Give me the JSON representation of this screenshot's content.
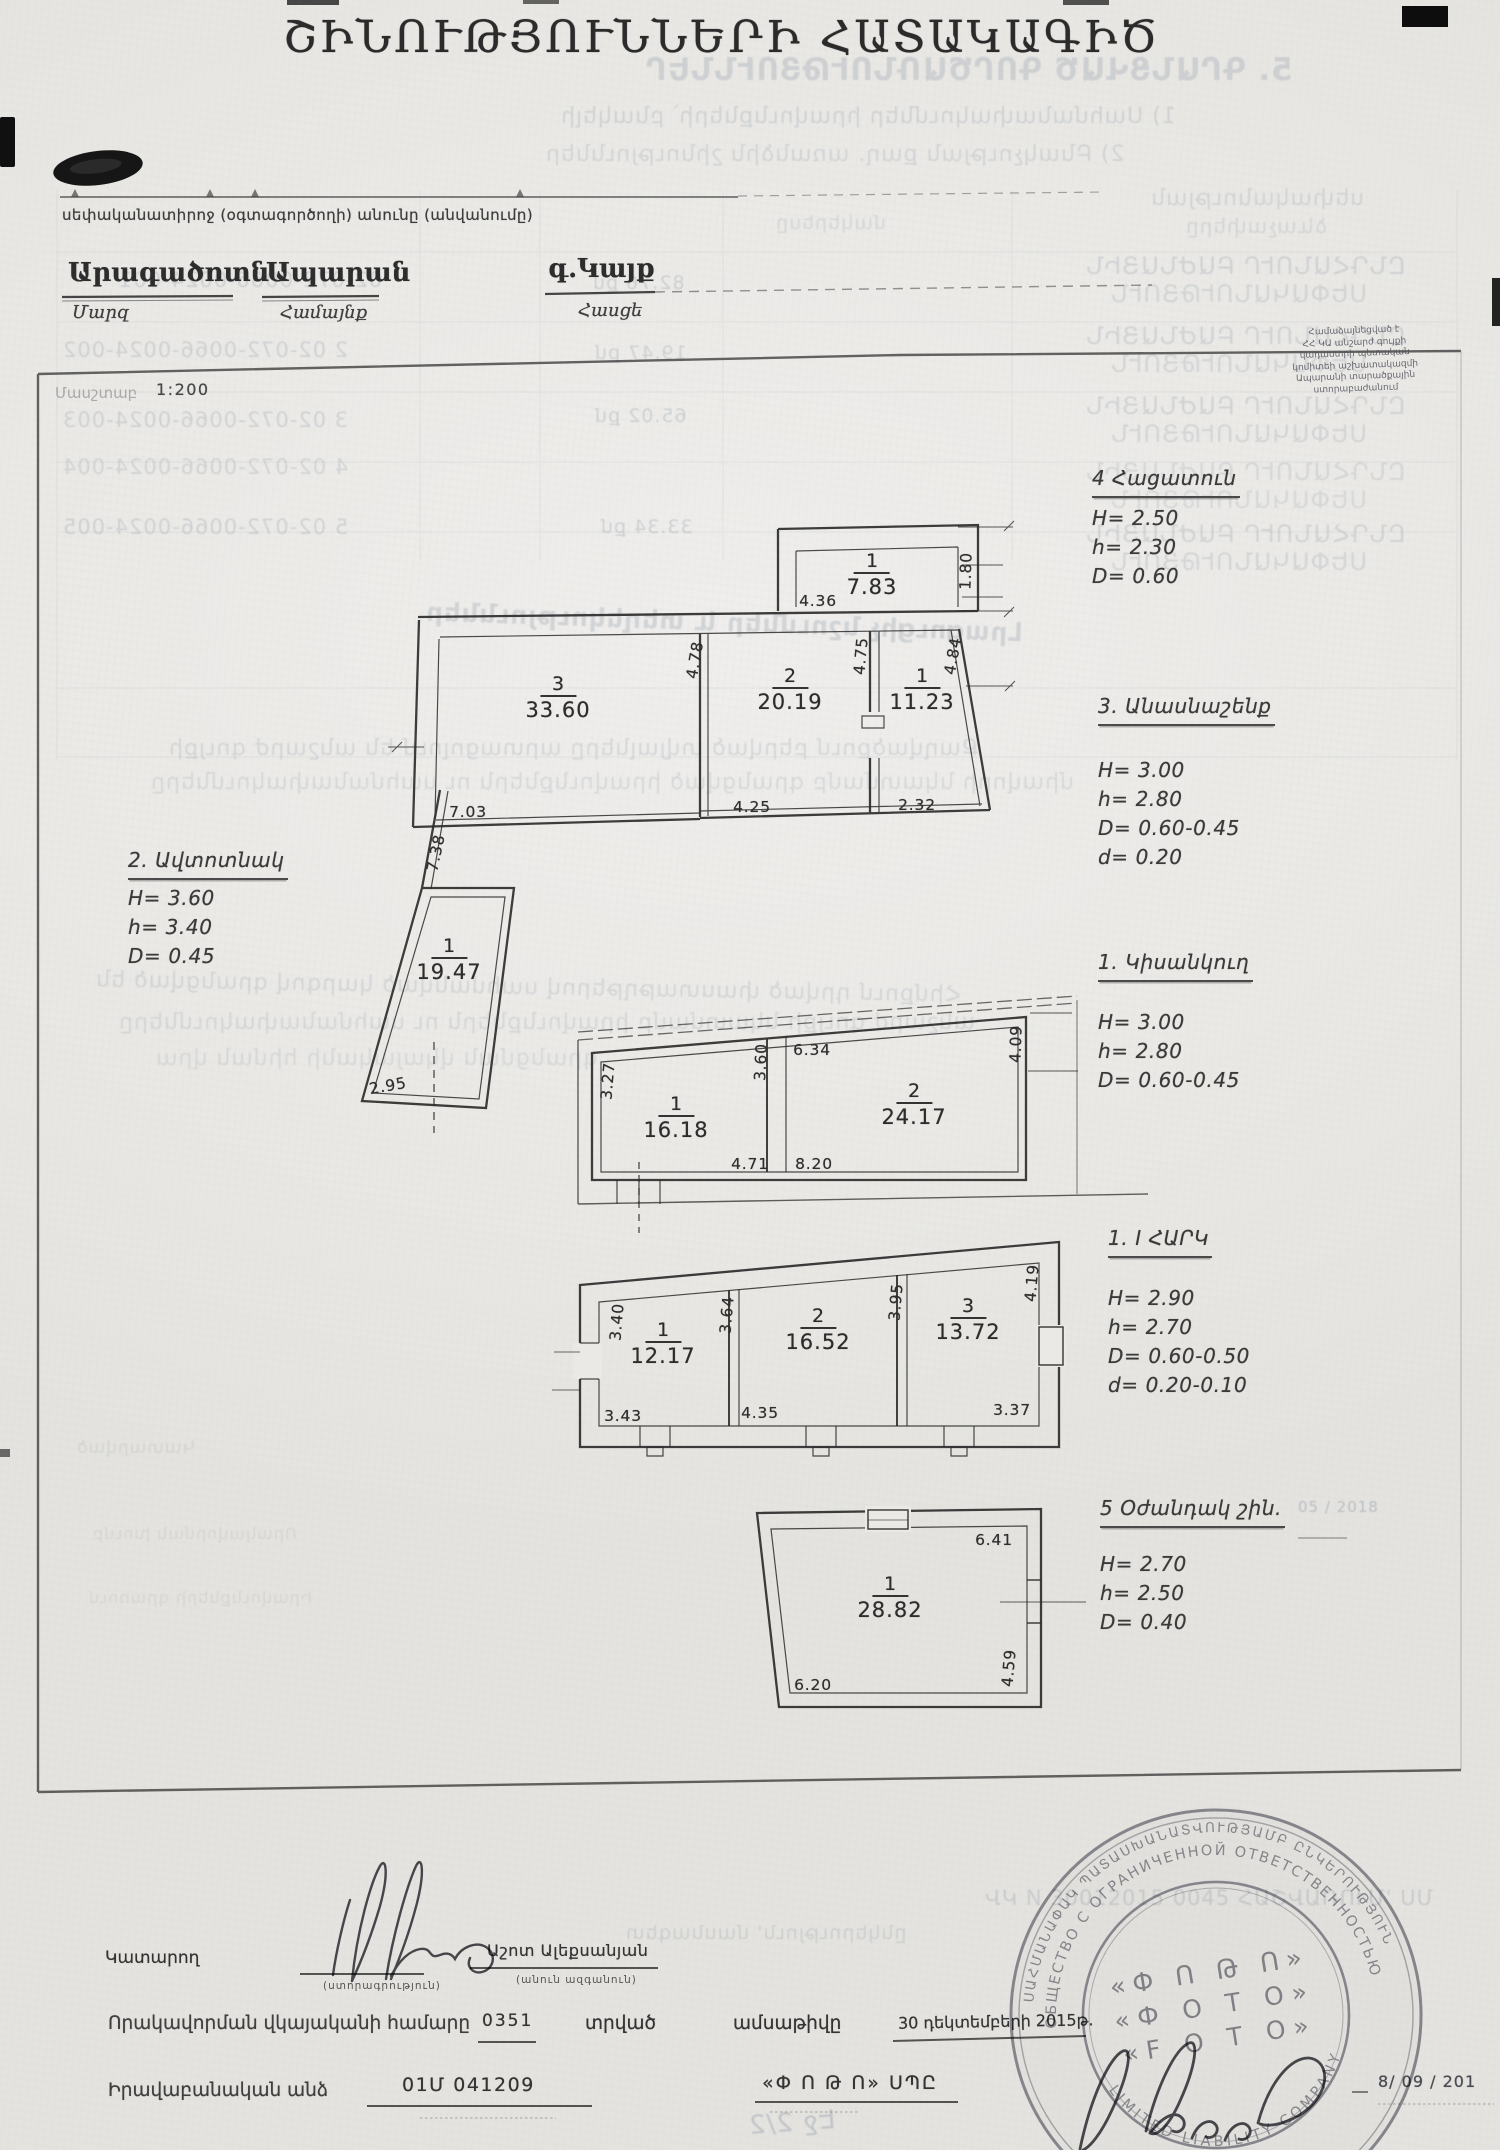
{
  "header": {
    "title": "ՇԻՆՈՒԹՅՈՒՆՆԵՐԻ ՀԱՏԱԿԱԳԻԾ",
    "owner_line": "սեփականատիրոջ (օգտագործողի) անունը (անվանումը)",
    "fields": {
      "marz": {
        "value": "Արագածոտն",
        "label": "Մարզ"
      },
      "community": {
        "value": "Ապարան",
        "label": "Համայնք"
      },
      "address": {
        "value": "գ.Կայք",
        "label": "Հասցե"
      }
    },
    "scale": {
      "label": "Մասշտաբ",
      "value": "1:200"
    }
  },
  "annotations": [
    {
      "id": "garage",
      "title": "2. Ավտոտնակ",
      "lines": [
        "H= 3.60",
        "h= 3.40",
        "D= 0.45"
      ],
      "x": 128,
      "y": 846,
      "gap": 4
    },
    {
      "id": "bakehouse",
      "title": "4 Հացատուն",
      "lines": [
        "H= 2.50",
        "h= 2.30",
        "D= 0.60"
      ],
      "x": 1092,
      "y": 464,
      "gap": 6
    },
    {
      "id": "barn",
      "title": "3. Անասնաշենք",
      "lines": [
        "H= 3.00",
        "h= 2.80",
        "D= 0.60-0.45",
        "d= 0.20"
      ],
      "x": 1098,
      "y": 692,
      "gap": 30
    },
    {
      "id": "basement",
      "title": "1. Կիսանկուղ",
      "lines": [
        "H= 3.00",
        "h= 2.80",
        "D= 0.60-0.45"
      ],
      "x": 1098,
      "y": 948,
      "gap": 26
    },
    {
      "id": "first-floor",
      "title": "1. I ՀԱՐԿ",
      "lines": [
        "H= 2.90",
        "h= 2.70",
        "D= 0.60-0.50",
        "d= 0.20-0.10"
      ],
      "x": 1108,
      "y": 1224,
      "gap": 26
    },
    {
      "id": "auxiliary",
      "title": "5 Օժանդակ շին.",
      "lines": [
        "H= 2.70",
        "h= 2.50",
        "D= 0.40"
      ],
      "x": 1100,
      "y": 1494,
      "gap": 22
    }
  ],
  "plans": {
    "barn-plan": {
      "rooms": [
        {
          "n": "1",
          "a": "7.83",
          "x": 872,
          "y": 551
        },
        {
          "n": "3",
          "a": "33.60",
          "x": 558,
          "y": 674
        },
        {
          "n": "2",
          "a": "20.19",
          "x": 790,
          "y": 666
        },
        {
          "n": "1",
          "a": "11.23",
          "x": 922,
          "y": 666
        }
      ],
      "dims": [
        {
          "v": "4.36",
          "x": 818,
          "y": 601
        },
        {
          "v": "1.80",
          "x": 966,
          "y": 571,
          "r": -88
        },
        {
          "v": "4.78",
          "x": 695,
          "y": 660,
          "r": -80
        },
        {
          "v": "4.75",
          "x": 861,
          "y": 656,
          "r": -85
        },
        {
          "v": "4.84",
          "x": 953,
          "y": 656,
          "r": -80
        },
        {
          "v": "7.03",
          "x": 468,
          "y": 812
        },
        {
          "v": "4.25",
          "x": 752,
          "y": 807
        },
        {
          "v": "2.32",
          "x": 917,
          "y": 805
        }
      ]
    },
    "garage-plan": {
      "rooms": [
        {
          "n": "1",
          "a": "19.47",
          "x": 449,
          "y": 936
        }
      ],
      "dims": [
        {
          "v": "7.38",
          "x": 436,
          "y": 853,
          "r": -78
        },
        {
          "v": "2.95",
          "x": 388,
          "y": 1086,
          "r": -10
        }
      ]
    },
    "basement-plan": {
      "rooms": [
        {
          "n": "1",
          "a": "16.18",
          "x": 676,
          "y": 1094
        },
        {
          "n": "2",
          "a": "24.17",
          "x": 914,
          "y": 1081
        }
      ],
      "dims": [
        {
          "v": "3.27",
          "x": 608,
          "y": 1081,
          "r": -85
        },
        {
          "v": "3.60",
          "x": 761,
          "y": 1062,
          "r": -87
        },
        {
          "v": "6.34",
          "x": 812,
          "y": 1050
        },
        {
          "v": "4.09",
          "x": 1016,
          "y": 1044,
          "r": -88
        },
        {
          "v": "4.71",
          "x": 750,
          "y": 1164
        },
        {
          "v": "8.20",
          "x": 814,
          "y": 1164
        }
      ]
    },
    "first-floor-plan": {
      "rooms": [
        {
          "n": "1",
          "a": "12.17",
          "x": 663,
          "y": 1320
        },
        {
          "n": "2",
          "a": "16.52",
          "x": 818,
          "y": 1306
        },
        {
          "n": "3",
          "a": "13.72",
          "x": 968,
          "y": 1296
        }
      ],
      "dims": [
        {
          "v": "3.40",
          "x": 617,
          "y": 1322,
          "r": -85
        },
        {
          "v": "3.64",
          "x": 727,
          "y": 1315,
          "r": -85
        },
        {
          "v": "3.95",
          "x": 896,
          "y": 1302,
          "r": -85
        },
        {
          "v": "4.19",
          "x": 1032,
          "y": 1283,
          "r": -85
        },
        {
          "v": "3.43",
          "x": 623,
          "y": 1416
        },
        {
          "v": "4.35",
          "x": 760,
          "y": 1413
        },
        {
          "v": "3.37",
          "x": 1012,
          "y": 1410
        }
      ]
    },
    "auxiliary-plan": {
      "rooms": [
        {
          "n": "1",
          "a": "28.82",
          "x": 890,
          "y": 1574
        }
      ],
      "dims": [
        {
          "v": "6.41",
          "x": 994,
          "y": 1540
        },
        {
          "v": "4.59",
          "x": 1009,
          "y": 1668,
          "r": -85
        },
        {
          "v": "6.20",
          "x": 813,
          "y": 1685
        }
      ]
    }
  },
  "footer": {
    "executor_label": "Կատարող",
    "signature_caption": "(ստորագրություն)",
    "name": "Աշոտ Ալեքսանյան",
    "name_caption": "(անուն ազգանուն)",
    "license_label": "Որակավորման վկայականի համարը",
    "license_no": "0351",
    "issued_word1": "տրված",
    "issued_word2": "ամսաթիվը",
    "issue_date": "30 դեկտեմբերի 2015թ.",
    "legal_label": "Իրավաբանական անձ",
    "legal_value": "01Մ 041209",
    "company": "«Փ Ո Թ Ո» ՍՊԸ",
    "date_fragment": "8/ 09 / 201"
  },
  "stamp": {
    "ring_outer": "ՍԱՀՄԱՆԱՓԱԿ ՊԱՏԱՍԽԱՆԱՏՎՈՒԹՅԱՄԲ ԸՆԿԵՐՈՒԹՅՈՒՆ",
    "ring_inner": "ОБЩЕСТВО С ОГРАНИЧЕННОЙ ОТВЕТСТВЕННОСТЬЮ",
    "ring_bottom": "LIMITED LIABILITY COMPANY",
    "center1": "«Փ Ո Թ Ո»",
    "center2": "«Ф О Т О»",
    "center3": "«F O T O»"
  },
  "approval": {
    "lines": [
      "Համաձայնեցված է",
      "ՀՀ ԿԱ անշարժ գույքի",
      "կադաստրի պետական",
      "կոմիտեի աշխատակազմի",
      "Ապարանի տարածքային",
      "ստորաբաժանում"
    ]
  },
  "bleedthrough": {
    "items": [
      {
        "t": "5. ԳՐԱՆՑՎԱԾ ԳՈՐԾԱՌՆՈՒԹՅՈՒՆՆԵՐ",
        "x": 645,
        "y": 52,
        "s": 31,
        "o": 0.3,
        "m": 1,
        "b": 1
      },
      {
        "t": "1) Սահմանափակումներ իրավունքների՝ բնակելի",
        "x": 560,
        "y": 104,
        "s": 22,
        "o": 0.28,
        "m": 1
      },
      {
        "t": "2) Բնակչության քաղ. առանձին շինություններ",
        "x": 545,
        "y": 142,
        "s": 22,
        "o": 0.26,
        "m": 1
      },
      {
        "t": "սեփականության",
        "x": 1150,
        "y": 186,
        "s": 22,
        "o": 0.26,
        "m": 1
      },
      {
        "t": "ձևաչափերը",
        "x": 1185,
        "y": 214,
        "s": 20,
        "o": 0.24,
        "m": 1
      },
      {
        "t": "մակերեսը",
        "x": 775,
        "y": 212,
        "s": 19,
        "o": 0.24,
        "m": 1
      },
      {
        "t": "02-072-0066-0024-001",
        "x": 118,
        "y": 268,
        "s": 21,
        "o": 0.3,
        "m": 1
      },
      {
        "t": "2   02-072-0066-0024-002",
        "x": 62,
        "y": 338,
        "s": 21,
        "o": 0.3,
        "m": 1
      },
      {
        "t": "3   02-072-0066-0024-003",
        "x": 62,
        "y": 408,
        "s": 21,
        "o": 0.3,
        "m": 1
      },
      {
        "t": "4   02-072-0066-0024-004",
        "x": 62,
        "y": 455,
        "s": 21,
        "o": 0.28,
        "m": 1
      },
      {
        "t": "5   02-072-0066-0024-005",
        "x": 62,
        "y": 515,
        "s": 21,
        "o": 0.3,
        "m": 1
      },
      {
        "t": "82.76 քմ",
        "x": 592,
        "y": 272,
        "s": 19,
        "o": 0.34,
        "m": 1
      },
      {
        "t": "19.47 քմ",
        "x": 594,
        "y": 342,
        "s": 19,
        "o": 0.32,
        "m": 1
      },
      {
        "t": "65.02 քմ",
        "x": 594,
        "y": 405,
        "s": 19,
        "o": 0.34,
        "m": 1
      },
      {
        "t": "33.34 քմ",
        "x": 600,
        "y": 516,
        "s": 19,
        "o": 0.34,
        "m": 1
      },
      {
        "t": "ԸՆԴՀԱՆՈՒՐ ԲԱԺՆԱՅԻՆ",
        "x": 1085,
        "y": 252,
        "s": 24,
        "o": 0.28,
        "m": 1
      },
      {
        "t": "ՍԵՓԱԿԱՆՈՒԹՅՈՒՆ",
        "x": 1110,
        "y": 280,
        "s": 24,
        "o": 0.26,
        "m": 1
      },
      {
        "t": "ԸՆԴՀԱՆՈՒՐ ԲԱԺՆԱՅԻՆ",
        "x": 1085,
        "y": 322,
        "s": 24,
        "o": 0.28,
        "m": 1
      },
      {
        "t": "ՍԵՓԱԿԱՆՈՒԹՅՈՒՆ",
        "x": 1110,
        "y": 350,
        "s": 24,
        "o": 0.26,
        "m": 1
      },
      {
        "t": "ԸՆԴՀԱՆՈՒՐ ԲԱԺՆԱՅԻՆ",
        "x": 1085,
        "y": 392,
        "s": 24,
        "o": 0.28,
        "m": 1
      },
      {
        "t": "ՍԵՓԱԿԱՆՈՒԹՅՈՒՆ",
        "x": 1110,
        "y": 420,
        "s": 24,
        "o": 0.26,
        "m": 1
      },
      {
        "t": "ԸՆԴՀԱՆՈՒՐ ԲԱԺՆԱՅԻՆ",
        "x": 1085,
        "y": 458,
        "s": 24,
        "o": 0.24,
        "m": 1
      },
      {
        "t": "ՍԵՓԱԿԱՆՈՒԹՅՈՒՆ",
        "x": 1110,
        "y": 486,
        "s": 24,
        "o": 0.22,
        "m": 1
      },
      {
        "t": "ԸՆԴՀԱՆՈՒՐ ԲԱԺՆԱՅԻՆ",
        "x": 1085,
        "y": 520,
        "s": 24,
        "o": 0.28,
        "m": 1
      },
      {
        "t": "ՍԵՓԱԿԱՆՈՒԹՅՈՒՆ",
        "x": 1110,
        "y": 548,
        "s": 24,
        "o": 0.26,
        "m": 1
      },
      {
        "t": "Լրացուցիչ նշումներ և տեղեկություններ",
        "x": 425,
        "y": 608,
        "s": 26,
        "o": 0.3,
        "m": 1,
        "r": -2,
        "b": 1
      },
      {
        "t": "Քաղվածքում բերված տվյալները արտացոլում են անշարժ գույքի",
        "x": 168,
        "y": 736,
        "s": 22,
        "o": 0.26,
        "m": 1
      },
      {
        "t": "միավորի նկատմամբ գրանցված իրավունքներն ու սահմանափակումները",
        "x": 150,
        "y": 770,
        "s": 22,
        "o": 0.24,
        "m": 1
      },
      {
        "t": "Հիմքում դրված փաստաթղթերով սահմանված կարգով գրանցված են",
        "x": 95,
        "y": 975,
        "s": 22,
        "o": 0.26,
        "m": 1,
        "r": -1
      },
      {
        "t": "անշարժ գույքի նկատմամբ իրավունքներն ու սահմանափակումները",
        "x": 118,
        "y": 1010,
        "s": 22,
        "o": 0.24,
        "m": 1
      },
      {
        "t": "գրանցման վկայականի հիման վրա",
        "x": 155,
        "y": 1046,
        "s": 22,
        "o": 0.22,
        "m": 1
      },
      {
        "t": "Կատարված",
        "x": 76,
        "y": 1438,
        "s": 17,
        "o": 0.2,
        "m": 1
      },
      {
        "t": "Որակավորման խումբ",
        "x": 92,
        "y": 1524,
        "s": 16,
        "o": 0.18,
        "m": 1
      },
      {
        "t": "Իրավունքների գրառում",
        "x": 88,
        "y": 1588,
        "s": 16,
        "o": 0.18,
        "m": 1
      },
      {
        "t": "05 / 2018",
        "x": 1298,
        "y": 1498,
        "s": 15,
        "o": 0.5,
        "m": 0
      },
      {
        "t": "ՎԿ N 30012015 0045 ՀԱՇՎԱՌՈՒՄ' ՍՄ",
        "x": 985,
        "y": 1886,
        "s": 21,
        "o": 0.32,
        "m": 0
      },
      {
        "t": "ընկերություն' մասնագետ",
        "x": 625,
        "y": 1922,
        "s": 19,
        "o": 0.28,
        "m": 1
      },
      {
        "t": "Էջ 2/2",
        "x": 748,
        "y": 2108,
        "s": 26,
        "o": 0.42,
        "m": 1,
        "r": 4
      }
    ]
  }
}
